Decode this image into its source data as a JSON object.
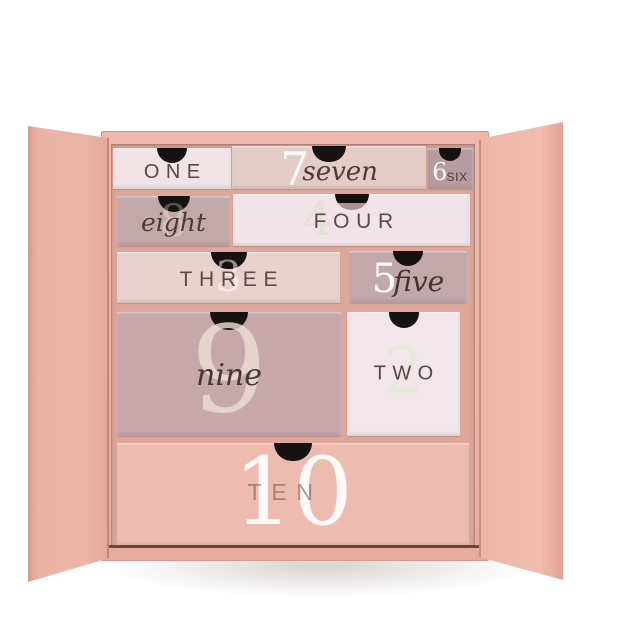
{
  "scene": {
    "type": "product-photo",
    "description": "Open blush-pink advent calendar gift box with ten numbered drawers",
    "background_color": "#ffffff"
  },
  "box": {
    "shell_color": "#ecb5a8",
    "left_flap_color": "#eab4a7",
    "right_flap_color": "#eeb9ac",
    "cavity_color": "#dda89b",
    "bottom_edge_color": "#503429",
    "notch_color": "#171212"
  },
  "drawers": [
    {
      "key": "one",
      "numeral": "",
      "word": "ONE",
      "style": "caps",
      "bg": "#f0e4e7",
      "word_color": "#574749",
      "numeral_color": "rgba(255,255,255,0.4)"
    },
    {
      "key": "seven",
      "numeral": "7",
      "word": "seven",
      "style": "script",
      "bg": "#e3ccc3",
      "word_color": "#4a3b39",
      "numeral_color": "rgba(255,255,255,0.9)"
    },
    {
      "key": "six",
      "numeral": "6",
      "word": "SIX",
      "style": "caps",
      "bg": "#b69c9f",
      "word_color": "#44383a",
      "numeral_color": "rgba(255,255,255,0.92)"
    },
    {
      "key": "eight",
      "numeral": "8",
      "word": "eight",
      "style": "script",
      "bg": "#c3a8aa",
      "word_color": "#4a3a38",
      "numeral_color": "rgba(255,255,255,0.28)"
    },
    {
      "key": "four",
      "numeral": "4",
      "word": "FOUR",
      "style": "caps",
      "bg": "#f1e4e8",
      "word_color": "#5a4a4b",
      "numeral_color": "rgba(222,226,211,0.9)"
    },
    {
      "key": "three",
      "numeral": "3",
      "word": "THREE",
      "style": "caps",
      "bg": "#e9d2ce",
      "word_color": "#5c4a48",
      "numeral_color": "rgba(255,255,255,0.5)"
    },
    {
      "key": "five",
      "numeral": "5",
      "word": "five",
      "style": "script",
      "bg": "#c2a7ab",
      "word_color": "#423432",
      "numeral_color": "rgba(255,255,255,0.95)"
    },
    {
      "key": "nine",
      "numeral": "9",
      "word": "nine",
      "style": "script",
      "bg": "#c6a7ac",
      "word_color": "#463634",
      "numeral_color": "rgba(236,223,215,0.8)"
    },
    {
      "key": "two",
      "numeral": "2",
      "word": "TWO",
      "style": "caps",
      "bg": "#f2e6ea",
      "word_color": "#564648",
      "numeral_color": "rgba(226,233,216,0.85)"
    },
    {
      "key": "ten",
      "numeral": "10",
      "word": "TEN",
      "style": "caps",
      "bg": "#edbbaf",
      "word_color": "rgba(124,101,93,0.65)",
      "numeral_color": "rgba(255,255,255,0.92)"
    }
  ]
}
